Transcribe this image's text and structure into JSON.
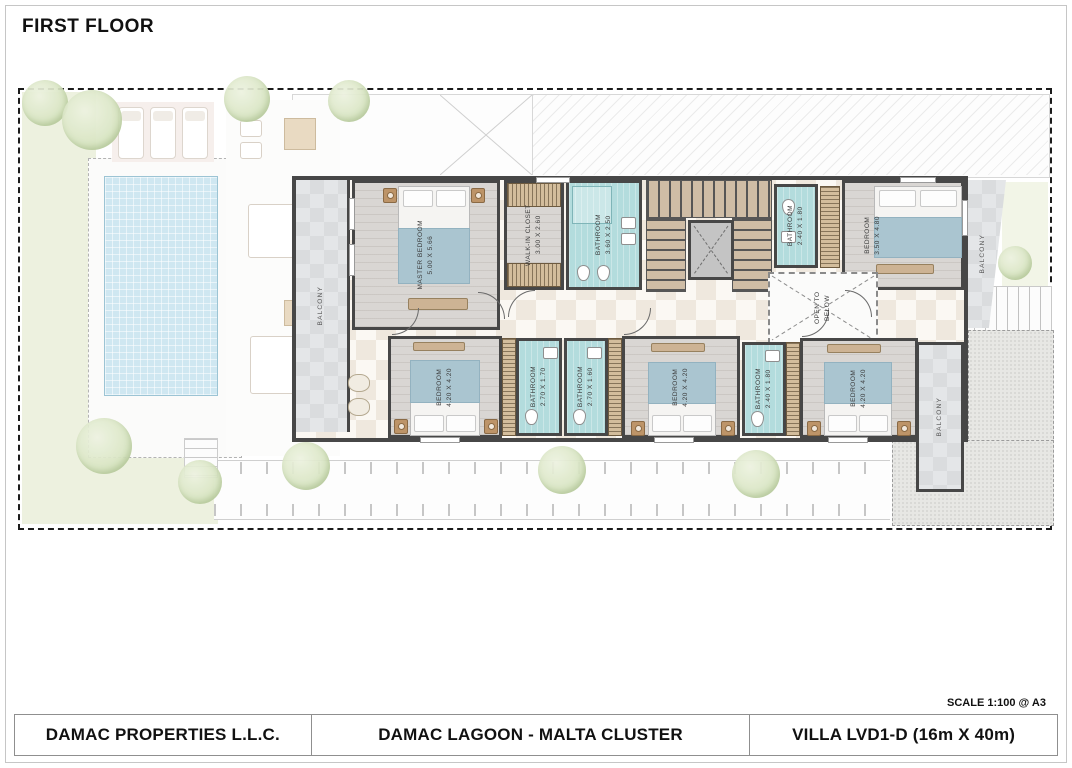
{
  "page": {
    "floor_title": "FIRST FLOOR",
    "scale_note": "SCALE 1:100 @ A3"
  },
  "title_block": {
    "company": "DAMAC PROPERTIES L.L.C.",
    "project": "DAMAC LAGOON - MALTA CLUSTER",
    "villa": "VILLA LVD1-D (16m X 40m)"
  },
  "rooms": {
    "master_bedroom": {
      "label": "MASTER BEDROOM",
      "dims": "5.00 X 5.66"
    },
    "walk_in_closet": {
      "label": "WALK-IN CLOSET",
      "dims": "3.00 X 2.60"
    },
    "master_bathroom": {
      "label": "BATHROOM",
      "dims": "3.60 X 2.50"
    },
    "bathroom_top_right": {
      "label": "BATHROOM",
      "dims": "2.40 X 1.80"
    },
    "bedroom_top_right": {
      "label": "BEDROOM",
      "dims": "3.50 X 4.80"
    },
    "open_to_below": {
      "label": "OPEN TO BELOW"
    },
    "bedroom_bottom_left": {
      "label": "BEDROOM",
      "dims": "4.20 X 4.20"
    },
    "bathroom_bottom_left": {
      "label": "BATHROOM",
      "dims": "2.70 X 1.70"
    },
    "bathroom_bottom_mid": {
      "label": "BATHROOM",
      "dims": "2.70 X 1.60"
    },
    "bedroom_bottom_mid": {
      "label": "BEDROOM",
      "dims": "4.20 X 4.20"
    },
    "bathroom_bottom_right": {
      "label": "BATHROOM",
      "dims": "2.40 X 1.80"
    },
    "bedroom_bottom_right": {
      "label": "BEDROOM",
      "dims": "4.20 X 4.20"
    },
    "balcony_left": {
      "label": "BALCONY"
    },
    "balcony_top_right": {
      "label": "BALCONY"
    },
    "balcony_bottom_right": {
      "label": "BALCONY"
    }
  },
  "colors": {
    "wall": "#474747",
    "bathroom_floor": "#b3dcdd",
    "pool": "#cfe7f1",
    "garden": "#edf1df",
    "wood_floor": "#d9d6d3",
    "balcony_floor": "#e4e6e8",
    "wardrobe": "#d3bd9c",
    "bed_blanket": "#aac5d0"
  }
}
